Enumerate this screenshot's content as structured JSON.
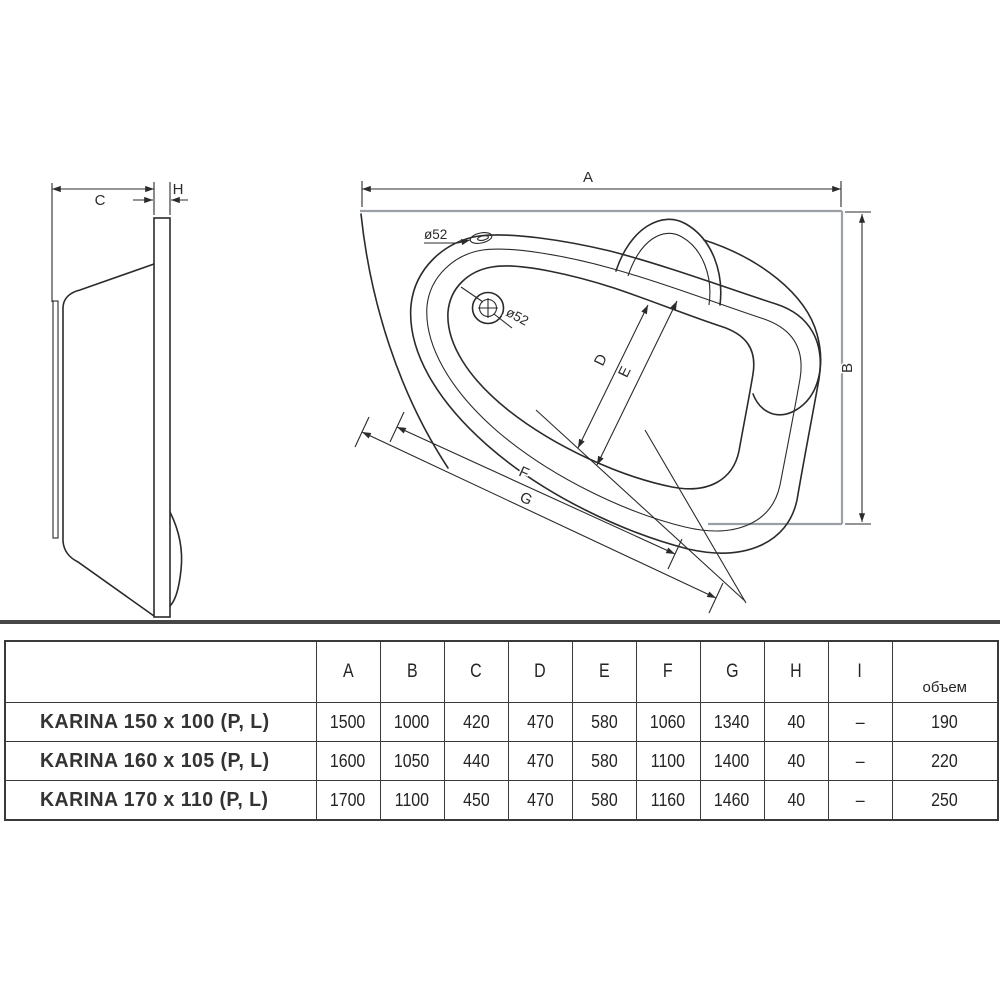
{
  "colors": {
    "line": "#2b2b2b",
    "gray": "#9aa0a6",
    "border": "#3a3a3a",
    "text": "#2f2f2f"
  },
  "diagram": {
    "top_view": {
      "label_a": "A",
      "label_b": "B",
      "label_d": "D",
      "label_e": "E",
      "label_f": "F",
      "label_g": "G",
      "overflow_diameter": "ø52",
      "drain_diameter": "ø52"
    },
    "side_view": {
      "label_c": "C",
      "label_h": "H"
    }
  },
  "table": {
    "volume_header": "объем",
    "dim_headers": [
      "A",
      "B",
      "C",
      "D",
      "E",
      "F",
      "G",
      "H",
      "I"
    ],
    "rows": [
      {
        "name": "KARINA  150 x 100 (P, L)",
        "values": [
          "1500",
          "1000",
          "420",
          "470",
          "580",
          "1060",
          "1340",
          "40",
          "–",
          "190"
        ]
      },
      {
        "name": "KARINA  160 x 105 (P, L)",
        "values": [
          "1600",
          "1050",
          "440",
          "470",
          "580",
          "1100",
          "1400",
          "40",
          "–",
          "220"
        ]
      },
      {
        "name": "KARINA  170 x 110 (P, L)",
        "values": [
          "1700",
          "1100",
          "450",
          "470",
          "580",
          "1160",
          "1460",
          "40",
          "–",
          "250"
        ]
      }
    ]
  }
}
